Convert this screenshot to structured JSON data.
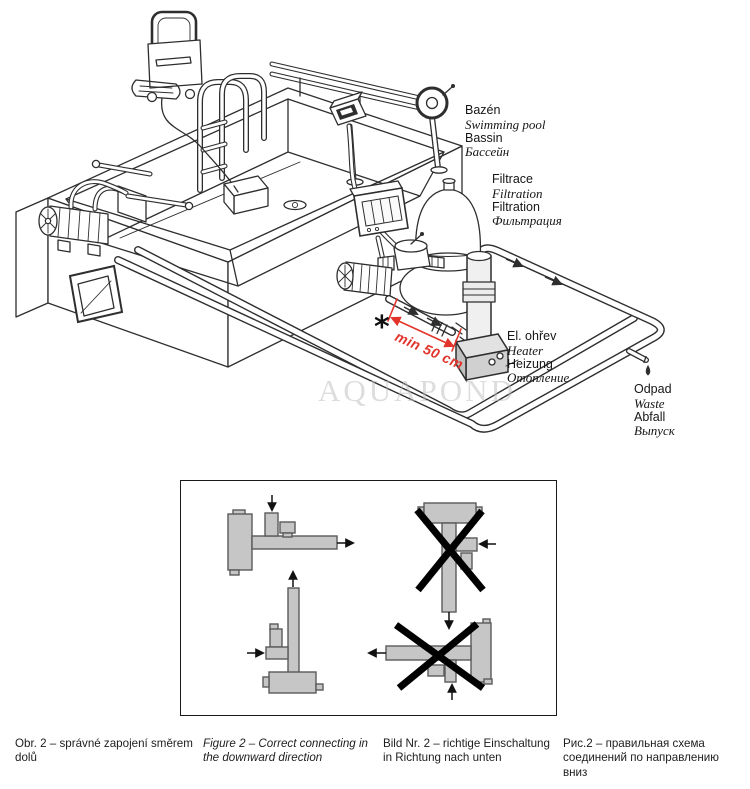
{
  "watermark": "AQUAPOND",
  "labels": {
    "pool": {
      "l1": "Bazén",
      "l2": "Swimming pool",
      "l3": "Bassin",
      "l4": "Бассейн"
    },
    "filtration": {
      "l1": "Filtrace",
      "l2": "Filtration",
      "l3": "Filtration",
      "l4": "Фильтрация"
    },
    "heater": {
      "l1": "El. ohřev",
      "l2": "Heater",
      "l3": "Heizung",
      "l4": "Отопление"
    },
    "waste": {
      "l1": "Odpad",
      "l2": "Waste",
      "l3": "Abfall",
      "l4": "Выпуск"
    }
  },
  "annotations": {
    "asterisk": "*",
    "min_distance": "min 50 cm"
  },
  "captions": {
    "cs": "Obr. 2 – správné zapojení směrem dolů",
    "en": "Figure 2 – Correct connecting in the downward direction",
    "de": "Bild Nr. 2 – richtige Einschaltung in Richtung nach unten",
    "ru": "Рис.2 – правильная схема соединений по направлению вниз"
  },
  "colors": {
    "line": "#2e2e2e",
    "accent_red": "#e2342b",
    "schematic_fill": "#c6c6c6",
    "schematic_stroke": "#5a5a5a",
    "watermark_gray": "#d6d6d6"
  }
}
